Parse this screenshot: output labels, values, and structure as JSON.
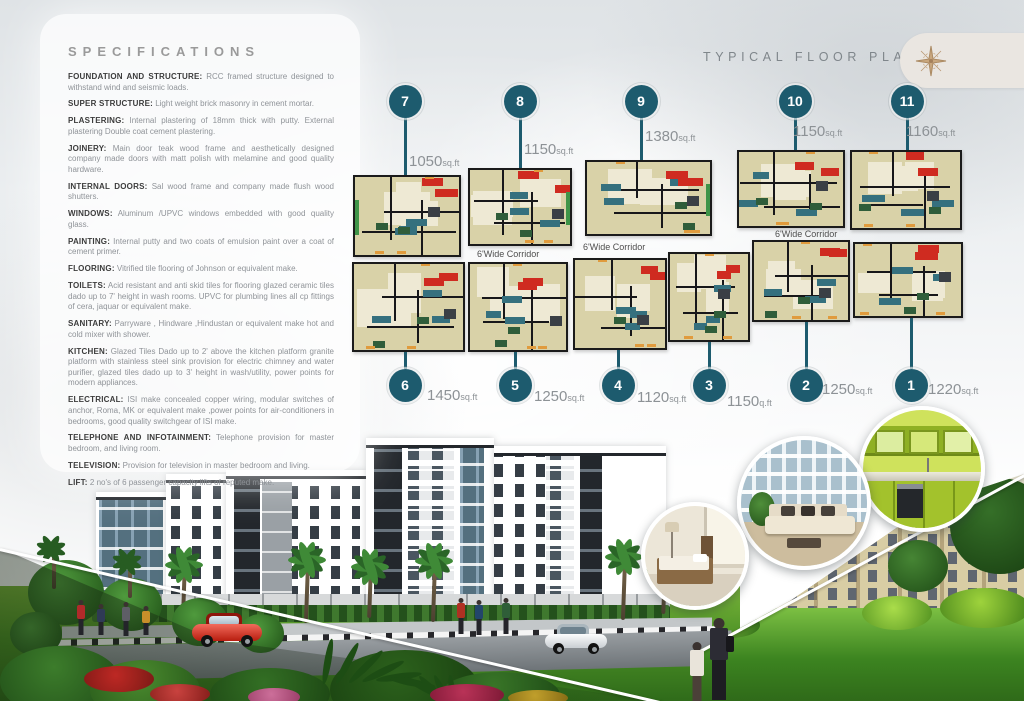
{
  "brochure": {
    "specifications": {
      "title": "SPECIFICATIONS",
      "items": [
        {
          "label": "FOUNDATION AND STRUCTURE:",
          "text": "RCC framed structure designed to withstand wind and seismic loads."
        },
        {
          "label": "SUPER STRUCTURE:",
          "text": "Light weight brick masonry in cement mortar."
        },
        {
          "label": "PLASTERING:",
          "text": "Internal plastering of 18mm thick with putty. External plastering Double coat cement plastering."
        },
        {
          "label": "JOINERY:",
          "text": "Main door teak wood frame and aesthetically designed company made doors with matt polish with melamine and good quality hardware."
        },
        {
          "label": "INTERNAL DOORS:",
          "text": "Sal wood frame and company made flush wood shutters."
        },
        {
          "label": "WINDOWS:",
          "text": "Aluminum /UPVC windows embedded with good quality glass."
        },
        {
          "label": "PAINTING:",
          "text": "Internal putty and two coats of emulsion paint over a coat of cement primer."
        },
        {
          "label": "FLOORING:",
          "text": "Vitrified tile flooring of Johnson or equivalent make."
        },
        {
          "label": "TOILETS:",
          "text": "Acid resistant and anti skid tiles for flooring glazed ceramic tiles dado up to 7' height in wash rooms. UPVC for plumbing lines all cp fittings of cera, jaquar or equivalent make."
        },
        {
          "label": "SANITARY:",
          "text": "Parryware , Hindware ,Hindustan or equivalent make hot and cold mixer with shower."
        },
        {
          "label": "KITCHEN:",
          "text": "Glazed Tiles Dado up to 2' above the kitchen platform granite platform with stainless steel sink provision for electric chimney and water purifier, glazed tiles dado up to 3' height in wash/utility, power points for modern appliances."
        },
        {
          "label": "ELECTRICAL:",
          "text": "ISI make concealed copper wiring, modular switches of anchor, Roma, MK or equivalent make ,power points for air-conditioners in bedrooms, good quality switchgear of ISI make."
        },
        {
          "label": "TELEPHONE AND INFOTAINMENT:",
          "text": "Telephone provision for master bedroom, and living room."
        },
        {
          "label": "TELEVISION:",
          "text": "Provision for television in master bedroom and living."
        },
        {
          "label": "LIFT:",
          "text": "2 no's of 6 passenger capacity lifts of reputed make."
        }
      ]
    },
    "floor_plan": {
      "title": "TYPICAL FLOOR PLAN",
      "corridor_labels": [
        "6'Wide Corridor",
        "6'Wide Corridor",
        "6'Wide Corridor"
      ],
      "units": [
        {
          "number": "7",
          "area": "1050",
          "area_unit": "sq.ft"
        },
        {
          "number": "8",
          "area": "1150",
          "area_unit": "sq.ft"
        },
        {
          "number": "9",
          "area": "1380",
          "area_unit": "sq.ft"
        },
        {
          "number": "10",
          "area": "1150",
          "area_unit": "sq.ft"
        },
        {
          "number": "11",
          "area": "1160",
          "area_unit": "sq.ft"
        },
        {
          "number": "6",
          "area": "1450",
          "area_unit": "sq.ft"
        },
        {
          "number": "5",
          "area": "1250",
          "area_unit": "sq.ft"
        },
        {
          "number": "4",
          "area": "1120",
          "area_unit": "sq.ft"
        },
        {
          "number": "3",
          "area": "1150",
          "area_unit": "q.ft"
        },
        {
          "number": "2",
          "area": "1250",
          "area_unit": "sq.ft"
        },
        {
          "number": "1",
          "area": "1220",
          "area_unit": "sq.ft"
        }
      ]
    },
    "photo_insets": [
      "bedroom-photo",
      "living-room-photo",
      "kitchen-photo"
    ],
    "icons": {
      "compass": "compass-rose-icon"
    },
    "colors": {
      "marker_teal": "#1d5b6e",
      "plan_fill": "#d9d2a8",
      "plan_accent_red": "#cf2b20",
      "plan_accent_teal": "#35707e",
      "balcony_green": "#3f9448",
      "lawn_green": "#5aa02c"
    }
  }
}
